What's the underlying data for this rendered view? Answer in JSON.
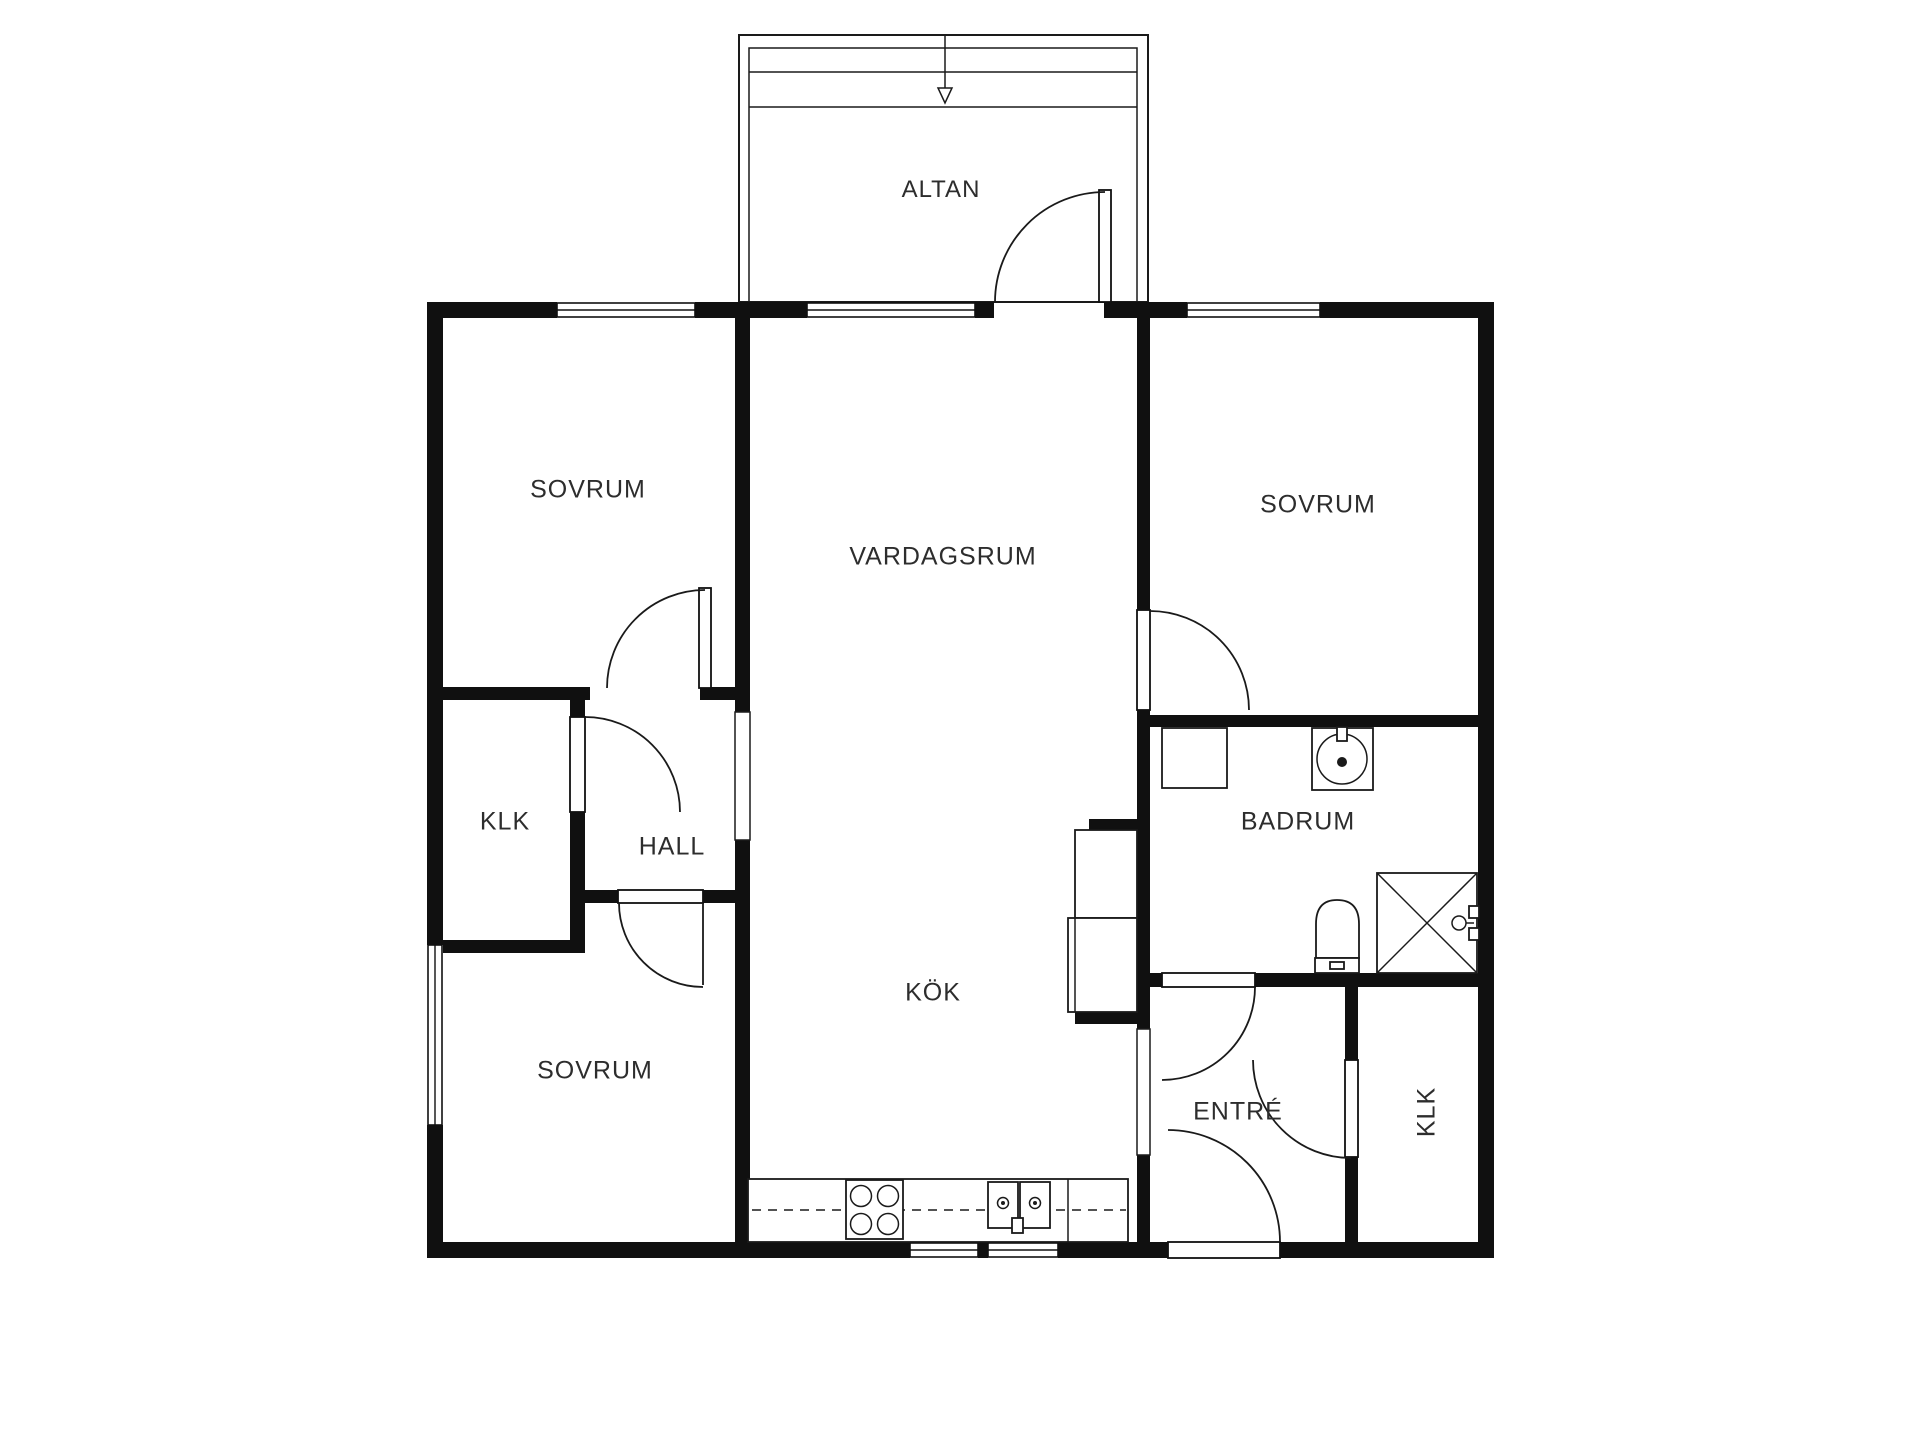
{
  "title": "Floor plan",
  "colors": {
    "background": "#ffffff",
    "wall": "#101010",
    "line": "#1a1a1a",
    "text": "#2d2d2d"
  },
  "rooms": {
    "altan": {
      "label": "ALTAN"
    },
    "sovrum_tl": {
      "label": "SOVRUM"
    },
    "vardagsrum": {
      "label": "VARDAGSRUM"
    },
    "sovrum_tr": {
      "label": "SOVRUM"
    },
    "klk_left": {
      "label": "KLK"
    },
    "hall": {
      "label": "HALL"
    },
    "badrum": {
      "label": "BADRUM"
    },
    "kok": {
      "label": "KÖK"
    },
    "sovrum_bl": {
      "label": "SOVRUM"
    },
    "entre": {
      "label": "ENTRÉ"
    },
    "klk_br": {
      "label": "KLK"
    }
  },
  "fixtures": [
    "stove-icon",
    "kitchen-sink-icon",
    "kitchen-counter",
    "refrigerator-icon",
    "freezer-icon",
    "washing-machine-icon",
    "bathroom-sink-icon",
    "toilet-icon",
    "shower-icon",
    "shower-faucet-icon",
    "entrance-arrow-icon"
  ]
}
